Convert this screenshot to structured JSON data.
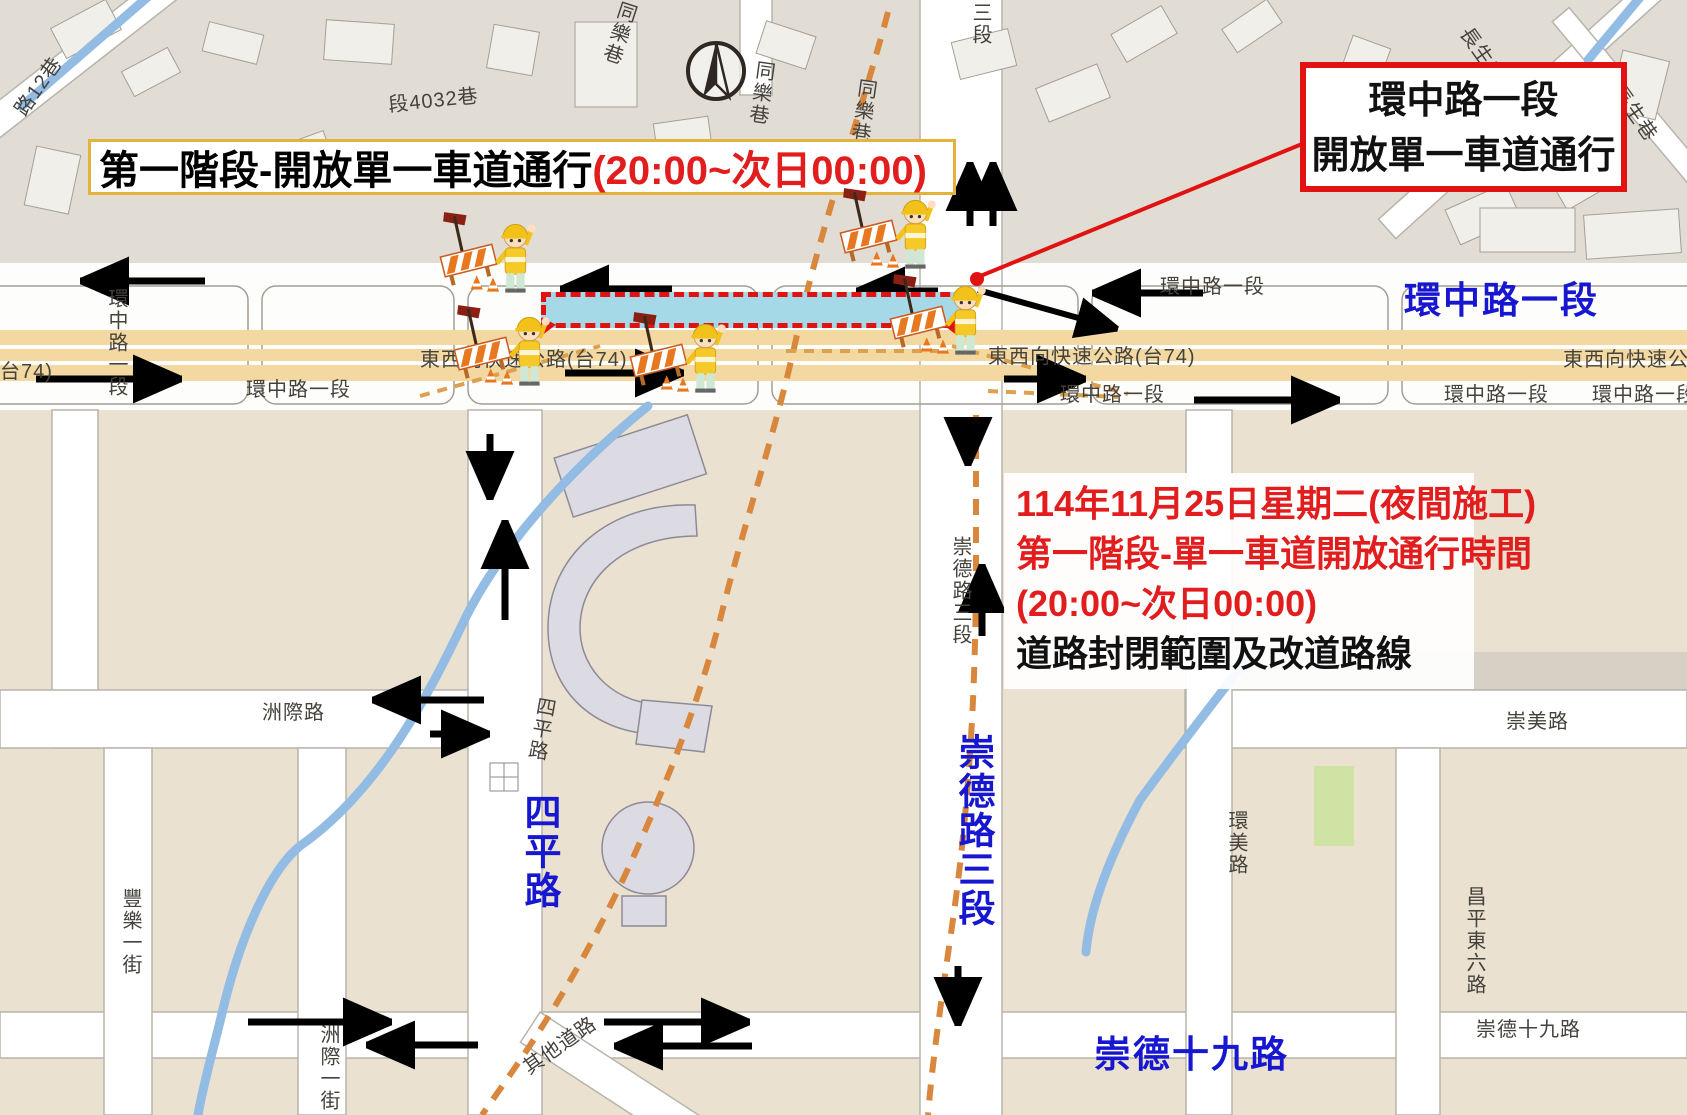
{
  "banners": {
    "phase": {
      "text_black": "第一階段-開放單一車道通行",
      "text_red": "(20:00~次日00:00)"
    },
    "callout": {
      "line1": "環中路一段",
      "line2": "開放單一車道通行"
    },
    "info": {
      "line1": "114年11月25日星期二(夜間施工)",
      "line2": "第一階段-單一車道開放通行時間",
      "line3": "(20:00~次日00:00)",
      "line4": "道路封閉範圍及改道路線"
    }
  },
  "highlighted_roads": {
    "huanzhong": "環中路一段",
    "siping": "四平路",
    "chongde3": "崇德路三段",
    "chongde19": "崇德十九路"
  },
  "streets": {
    "expressway": "東西向快速公路(台74)",
    "t74_part": "台74)",
    "huanzhong": "環中路一段",
    "zhouji": "洲際路",
    "chongmei": "崇美路",
    "huanmei": "環美路",
    "changping_e6": "昌平東六路",
    "chongde19": "崇德十九路",
    "fengle1": "豐樂一街",
    "zhouji1": "洲際一街",
    "other_roads": "其他道路",
    "siping": "四平路",
    "chongde3": "崇德路三段",
    "tongle": "同樂巷",
    "changsheng": "長生巷",
    "lane12": "路12巷",
    "lane4032": "段4032巷",
    "sec3_part": "三段"
  },
  "icons": {
    "compass": "north-compass",
    "worker": "construction-worker-with-barrier"
  },
  "colors": {
    "closure_fill": "#a6d9e8",
    "closure_border": "#e01212",
    "diversion_dash": "#d8873d",
    "expressway_fill": "#f3d9a1",
    "blue_road_label": "#1717d0",
    "alert_red": "#e11d1d"
  }
}
